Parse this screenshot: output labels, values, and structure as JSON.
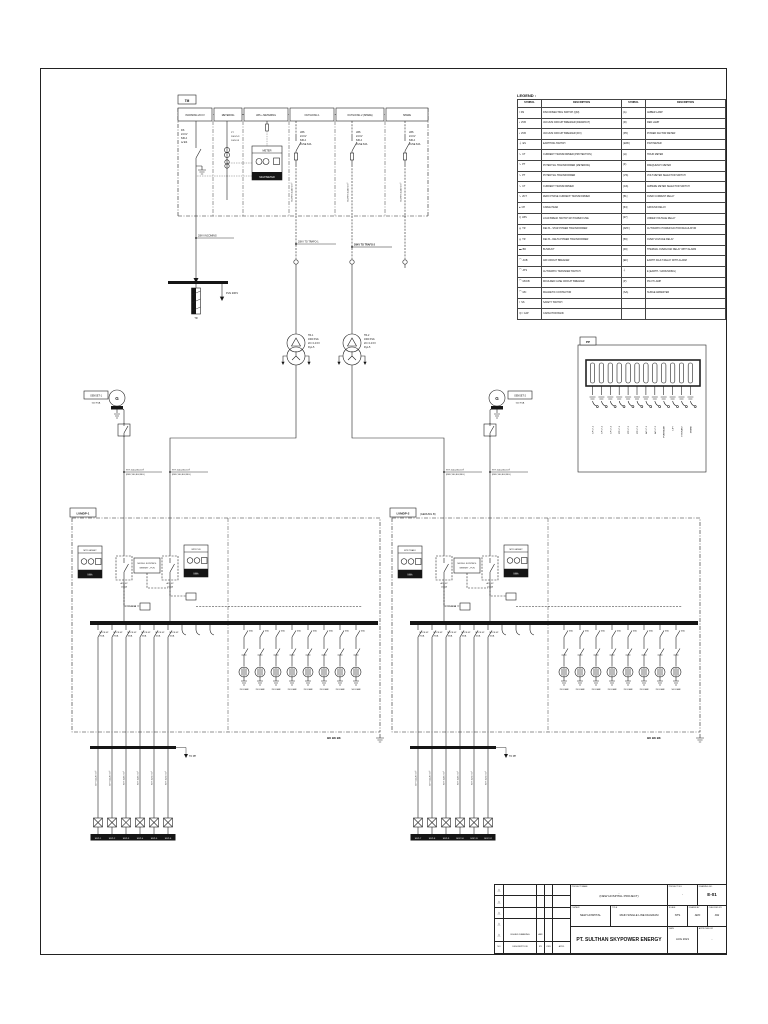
{
  "mv_panel": {
    "tag": "TM",
    "columns": [
      "INCOMING 20 KV",
      "METERING",
      "LBS + METERING",
      "OUTGOING 1",
      "OUTGOING 2 (SPARE)",
      "SPARE"
    ],
    "ds_lines": [
      "DS",
      "24 KV",
      "630 A",
      "w/ ES"
    ],
    "pt_lines": [
      "PT",
      "20KV/√3",
      "100V/√3"
    ],
    "meter": {
      "title": "METER",
      "bottom": "MULTIMETER"
    },
    "outgoing_lines": [
      "LBS",
      "24 KV",
      "630 A",
      "FUSE 63A"
    ],
    "outgoing_cable": "N2XSY 3x240 mm²",
    "cable_labels": [
      "20KV INCOMING",
      "20KV TO TRAFO-1",
      "20KV TO TRAFO-2"
    ],
    "pln_arrow": "PLN 20KV",
    "termination": "TR"
  },
  "transformers": [
    {
      "l1": "TR-1",
      "l2": "1600 KVA",
      "l3": "20 / 0.4 KV",
      "l4": "Dyn-5"
    },
    {
      "l1": "TR-2",
      "l2": "1600 KVA",
      "l3": "20 / 0.4 KV",
      "l4": "Dyn-5"
    }
  ],
  "gensets": [
    {
      "g": "G",
      "name": "GENSET-1",
      "rating": "500 KVA"
    },
    {
      "g": "G",
      "name": "GENSET-2",
      "rating": "500 KVA"
    }
  ],
  "lv_cable": {
    "top": "NYY 4x(1x240) mm²",
    "bottom": "(RED,YEL,BLK,BLU)"
  },
  "panels": [
    {
      "tag": "LVMDP-1",
      "suffix": "",
      "meter_left": "MTR GENSET",
      "meter_right": "MTR PLN",
      "kwh": "kWh",
      "acb_left": {
        "a": "ACB 4P",
        "b": "2000A"
      },
      "acb_right": {
        "a": "ACB 4P",
        "b": "2000A"
      },
      "module": {
        "a": "MODUL KONTROL",
        "b": "GENSET - PLN"
      },
      "ct": "CT 2500/5A",
      "feeders": [
        {
          "a": "MCCB 4P",
          "b": "250A"
        },
        {
          "a": "MCCB 4P",
          "b": "250A"
        },
        {
          "a": "MCCB 4P",
          "b": "160A"
        },
        {
          "a": "MCCB 4P",
          "b": "160A"
        },
        {
          "a": "MCCB 4P",
          "b": "100A"
        },
        {
          "a": "MCCB 4P",
          "b": "100A"
        }
      ],
      "cap_breaker": "63A",
      "caps": [
        "25 KVAR",
        "25 KVAR",
        "25 KVAR",
        "25 KVAR",
        "25 KVAR",
        "25 KVAR",
        "25 KVAR",
        "50 KVAR"
      ],
      "bus_marks": "BK  BK  BK",
      "stub": "TO PP",
      "drops": [
        {
          "cable": "NYY 4x120 mm²",
          "name": "SDP-1"
        },
        {
          "cable": "NYY 4x120 mm²",
          "name": "SDP-2"
        },
        {
          "cable": "NYY 4x95 mm²",
          "name": "SDP-3"
        },
        {
          "cable": "NYY 4x95 mm²",
          "name": "SDP-4"
        },
        {
          "cable": "NYY 4x70 mm²",
          "name": "SDP-5"
        },
        {
          "cable": "NYY 4x70 mm²",
          "name": "SDP-6"
        }
      ]
    },
    {
      "tag": "LVMDP-2",
      "suffix": "(GEDUNG B)",
      "meter_left": "MTR TRAFO",
      "meter_right": "MTR GENSET",
      "kwh": "kWh",
      "acb_left": {
        "a": "ACB 4P",
        "b": "2000A"
      },
      "acb_right": {
        "a": "ACB 4P",
        "b": "2000A"
      },
      "module": {
        "a": "MODUL KONTROL",
        "b": "GENSET - PLN"
      },
      "ct": "CT 2500/5A",
      "feeders": [
        {
          "a": "MCCB 4P",
          "b": "250A"
        },
        {
          "a": "MCCB 4P",
          "b": "250A"
        },
        {
          "a": "MCCB 4P",
          "b": "160A"
        },
        {
          "a": "MCCB 4P",
          "b": "160A"
        },
        {
          "a": "MCCB 4P",
          "b": "100A"
        },
        {
          "a": "MCCB 4P",
          "b": "100A"
        }
      ],
      "cap_breaker": "63A",
      "caps": [
        "25 KVAR",
        "25 KVAR",
        "25 KVAR",
        "25 KVAR",
        "25 KVAR",
        "25 KVAR",
        "25 KVAR",
        "50 KVAR"
      ],
      "bus_marks": "BK  BK  BK",
      "stub": "TO PP",
      "drops": [
        {
          "cable": "NYY 4x120 mm²",
          "name": "SDP-7"
        },
        {
          "cable": "NYY 4x120 mm²",
          "name": "SDP-8"
        },
        {
          "cable": "NYY 4x95 mm²",
          "name": "SDP-9"
        },
        {
          "cable": "NYY 4x95 mm²",
          "name": "SDP-10"
        },
        {
          "cable": "NYY 4x70 mm²",
          "name": "SDP-11"
        },
        {
          "cable": "NYY 4x70 mm²",
          "name": "SDP-12"
        }
      ]
    }
  ],
  "pp": {
    "tag": "PP",
    "circuits": [
      "LP LT-1",
      "LP LT-2",
      "LP LT-3",
      "PP LT-1",
      "PP LT-2",
      "PP LT-3",
      "AC LT-1",
      "AC LT-2",
      "POMPA AIR",
      "LIFT",
      "HYDRANT",
      "SPARE"
    ]
  },
  "legend": {
    "title": "LEGEND :",
    "headers": [
      "SYMBOL",
      "DESCRIPTION",
      "SYMBOL",
      "DESCRIPTION"
    ],
    "rows": [
      {
        "g1": "/",
        "c1": "DS",
        "d1": "DISCONNECTING SWITCH (QM)",
        "g2": "(A)",
        "d2": "AMBER LAMP"
      },
      {
        "g1": "▪",
        "c1": "VCB",
        "d1": "VACUUM CIRCUIT BREAKER (DRAWOUT)",
        "g2": "(R)",
        "d2": "RED LAMP"
      },
      {
        "g1": "▪",
        "c1": "VCB",
        "d1": "VACUUM CIRCUIT BREAKER (FIX)",
        "g2": "(PF)",
        "d2": "POWER FACTOR METER"
      },
      {
        "g1": "⏚",
        "c1": "ES",
        "d1": "EARTHING SWITCH",
        "g2": "(kWh)",
        "d2": "KWH METER"
      },
      {
        "g1": "∿",
        "c1": "CT",
        "d1": "CURRENT TRANSFORMER (PROTECTION)",
        "g2": "(H)",
        "d2": "HOUR METER"
      },
      {
        "g1": "∿",
        "c1": "PT",
        "d1": "POTENTIAL TRANSFORMER (METERING)",
        "g2": "(F)",
        "d2": "FREQUENCY METER"
      },
      {
        "g1": "∿",
        "c1": "PT",
        "d1": "POTENTIAL TRANSFORMER",
        "g2": "(VS)",
        "d2": "VOLT METER SELECTOR SWITCH"
      },
      {
        "g1": "∿",
        "c1": "CT",
        "d1": "CURRENT TRANSFORMER",
        "g2": "(AS)",
        "d2": "AMPERE METER SELECTOR SWITCH"
      },
      {
        "g1": "∿",
        "c1": "ZCT",
        "d1": "ZERO PHASE CURRENT TRANSFORMER",
        "g2": "[51]",
        "d2": "OVER CURRENT RELAY"
      },
      {
        "g1": "●",
        "c1": "CH",
        "d1": "CABLE HEAD",
        "g2": "[64]",
        "d2": "GROUND RELAY"
      },
      {
        "g1": "/▯",
        "c1": "LBS",
        "d1": "LOAD BREAK SWITCH W/ POWER FUSE",
        "g2": "[27]",
        "d2": "UNDER VOLTAGE RELAY"
      },
      {
        "g1": "◎",
        "c1": "TR",
        "d1": "DELTA - STAR POWER TRANSFORMER",
        "g2": "[APF]",
        "d2": "AUTOMATIC POWER FACTOR REGULATOR"
      },
      {
        "g1": "◎",
        "c1": "TR",
        "d1": "DELTA - DELTA POWER TRANSFORMER",
        "g2": "[59]",
        "d2": "OVER VOLTAGE RELAY"
      },
      {
        "g1": "▬",
        "c1": "BD",
        "d1": "BUSDUCT",
        "g2": "[49]",
        "d2": "THERMAL OVERLOAD RELAY WITH ALARM"
      },
      {
        "g1": "⌒",
        "c1": "ACB",
        "d1": "AIR CIRCUIT BREAKER",
        "g2": "[EF]",
        "d2": "EARTH FAULT RELAY WITH ALARM"
      },
      {
        "g1": "⌒",
        "c1": "ATS",
        "d1": "AUTOMATIC TRANSFER SWITCH",
        "g2": "⏚",
        "d2": "E (EARTH / GROUNDING)"
      },
      {
        "g1": "⌒",
        "c1": "MCCB",
        "d1": "MOULDED CASE CIRCUIT BREAKER",
        "g2": "(P)",
        "d2": "PILOT LAMP"
      },
      {
        "g1": "⌒",
        "c1": "MC",
        "d1": "MAGNETIC CONTACTOR",
        "g2": "(SA)",
        "d2": "SURGE ARRESTER"
      },
      {
        "g1": "⌇",
        "c1": "SS",
        "d1": "SAFETY SWITCH",
        "g2": "",
        "d2": ""
      },
      {
        "g1": "=|=",
        "c1": "CAP",
        "d1": "CAPACITOR BANK",
        "g2": "",
        "d2": ""
      }
    ]
  },
  "titleblock": {
    "revs": [
      "△",
      "△",
      "△",
      "△"
    ],
    "issued": {
      "tri": "△",
      "desc": "ISSUED DRAWING",
      "by": "ARF"
    },
    "cols": [
      "NO",
      "DESCRIPTION",
      "BY",
      "CKD",
      "APVD",
      "DATE"
    ],
    "project": {
      "label": "PROJECT NAME",
      "line1": "-",
      "line2": "(NEW HOSPITAL PROJECT)"
    },
    "project_no": {
      "label": "PROJECT NO.",
      "value": "-"
    },
    "drawing_no": {
      "label": "DRAWING NO.",
      "value": "E-01"
    },
    "owner": {
      "label": "OWNER",
      "value": "NEW HOSPITAL"
    },
    "title": {
      "label": "TITLE",
      "value": "MAIN SINGLE LINE DIAGRAM"
    },
    "scale": {
      "label": "SCALE",
      "value": "NTS"
    },
    "drawn": {
      "label": "DRAWN BY",
      "value": "ARF"
    },
    "checked": {
      "label": "CHECKED BY",
      "value": "AW"
    },
    "company": "PT. SULTHAN SKYPOWER ENERGY",
    "date": {
      "label": "DATE",
      "value": "AUG 2021"
    },
    "approved": {
      "label": "APPROVED BY",
      "value": "-"
    }
  }
}
